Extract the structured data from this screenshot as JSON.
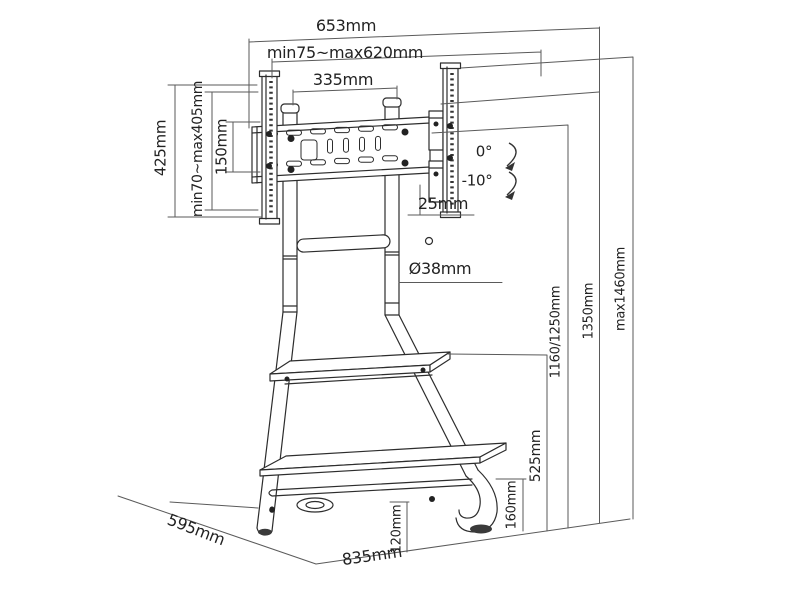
{
  "diagram": {
    "labels": {
      "overall_width": "653mm",
      "vesa_width_range": "min75~max620mm",
      "pole_spacing": "335mm",
      "bracket_height": "425mm",
      "vesa_height_range": "min70~max405mm",
      "rail_hole_spacing": "150mm",
      "tilt_upper": "0°",
      "tilt_lower": "-10°",
      "hook_offset": "25mm",
      "pole_diameter": "Ø38mm",
      "tv_center_height": "1160/1250mm",
      "pole_top_height": "1350mm",
      "max_height": "max1460mm",
      "shelf_height": "525mm",
      "foot_height": "160mm",
      "shelf_clearance": "120mm",
      "base_depth": "595mm",
      "base_width": "835mm"
    }
  }
}
